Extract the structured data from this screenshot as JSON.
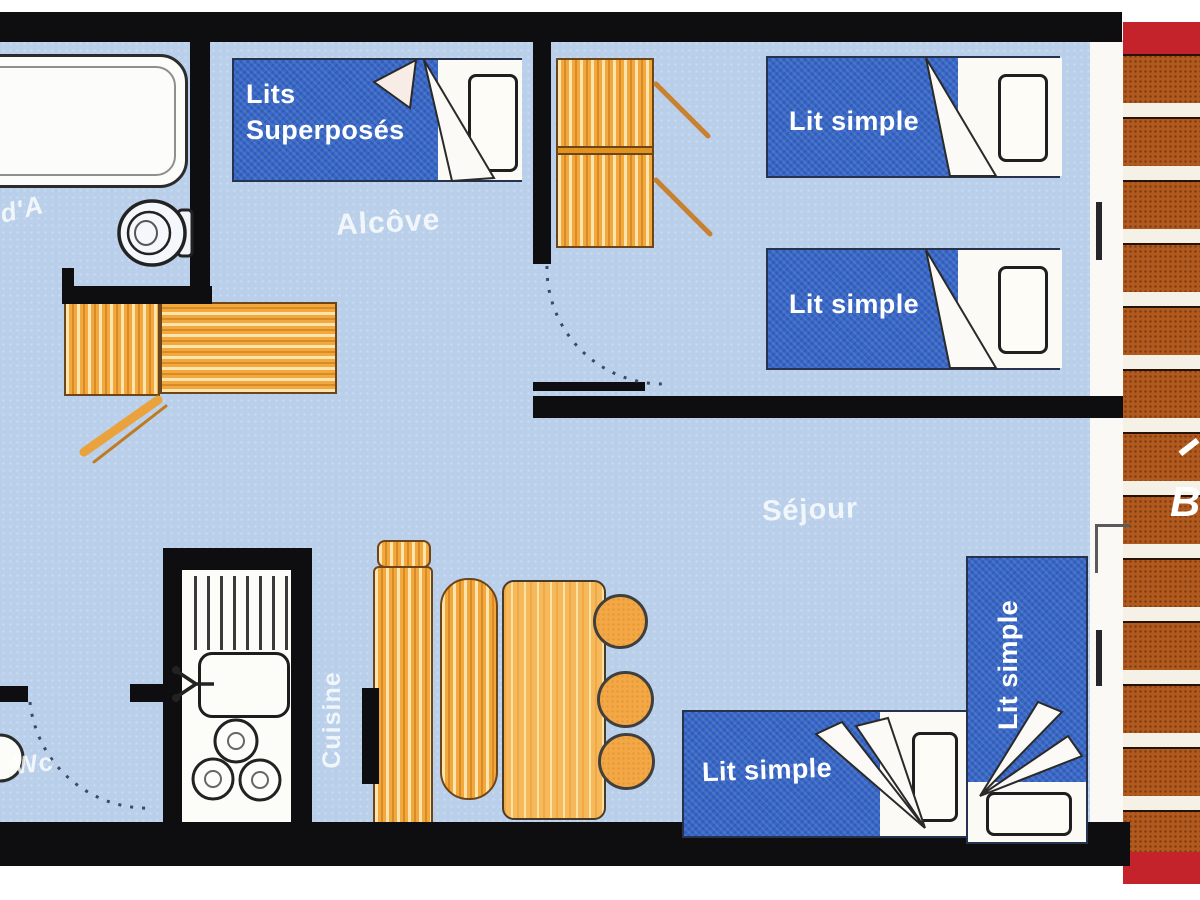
{
  "plan": {
    "type": "apartment-floor-plan",
    "labels": {
      "bunk_bed": "Lits\nSuperposés",
      "alcove": "Alcôve",
      "bed_top_1": "Lit simple",
      "bed_top_2": "Lit simple",
      "sejour": "Séjour",
      "bed_bottom_horizontal": "Lit simple",
      "bed_bottom_vertical": "Lit simple",
      "cuisine": "Cuisine",
      "wc": "Wc",
      "balcony_fragment": "B",
      "bathroom_fragment": "d'A"
    },
    "colors": {
      "floor": "#b9cfea",
      "wall": "#0e0e10",
      "bed_blue": "#3767c8",
      "bed_text": "#ffffff",
      "furniture_orange": "#f2a83b",
      "table_wood": "#f5b95c",
      "brick": "#b25a1e",
      "red_band": "#c5232b",
      "fixture_white": "#fbfaf6"
    }
  }
}
